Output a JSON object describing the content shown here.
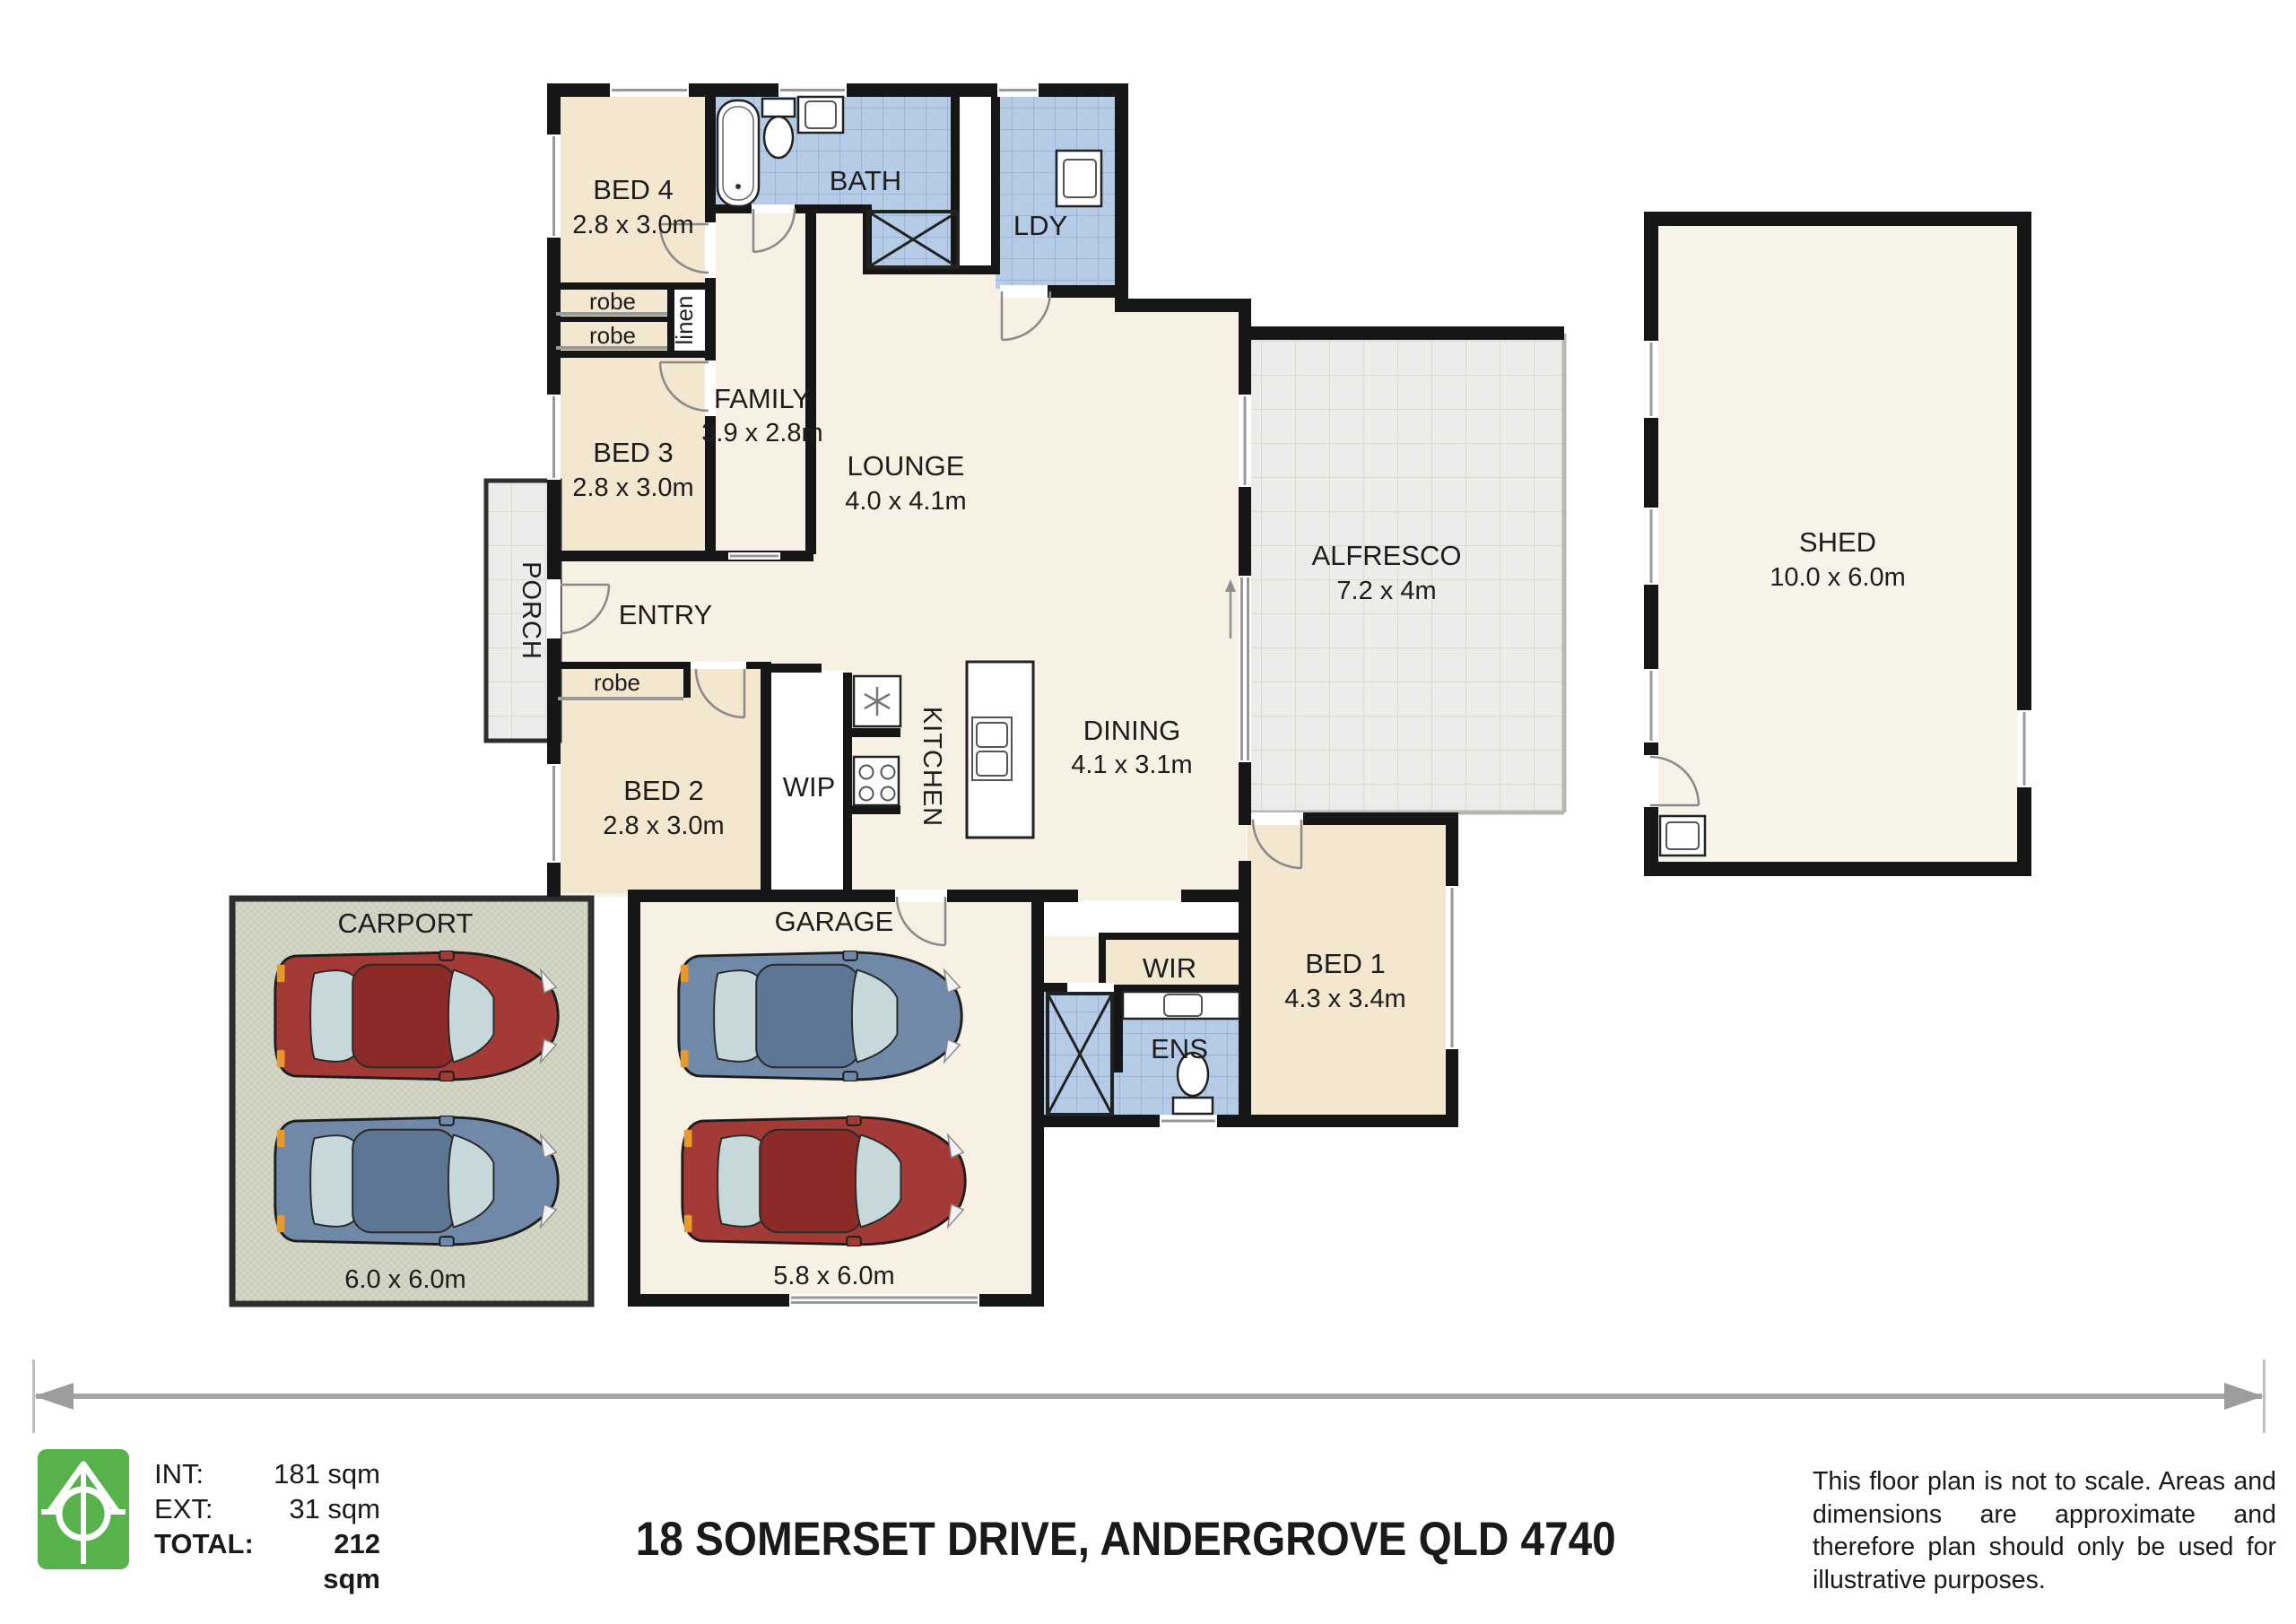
{
  "plan": {
    "rooms": {
      "bed4": {
        "name": "BED 4",
        "dims": "2.8 x 3.0m"
      },
      "bed3": {
        "name": "BED 3",
        "dims": "2.8 x 3.0m"
      },
      "bed2": {
        "name": "BED 2",
        "dims": "2.8 x 3.0m"
      },
      "bed1": {
        "name": "BED 1",
        "dims": "4.3 x 3.4m"
      },
      "bath": {
        "name": "BATH"
      },
      "ldy": {
        "name": "LDY"
      },
      "family": {
        "name": "FAMILY",
        "dims": "3.9 x 2.8m"
      },
      "lounge": {
        "name": "LOUNGE",
        "dims": "4.0 x 4.1m"
      },
      "dining": {
        "name": "DINING",
        "dims": "4.1 x 3.1m"
      },
      "kitchen": {
        "name": "KITCHEN"
      },
      "wip": {
        "name": "WIP"
      },
      "entry": {
        "name": "ENTRY"
      },
      "porch": {
        "name": "PORCH"
      },
      "alfresco": {
        "name": "ALFRESCO",
        "dims": "7.2 x 4m"
      },
      "wir": {
        "name": "WIR"
      },
      "ens": {
        "name": "ENS"
      },
      "garage": {
        "name": "GARAGE",
        "dims": "5.8 x 6.0m"
      },
      "carport": {
        "name": "CARPORT",
        "dims": "6.0 x 6.0m"
      },
      "shed": {
        "name": "SHED",
        "dims": "10.0 x 6.0m"
      },
      "robe_a": {
        "name": "robe"
      },
      "robe_b": {
        "name": "robe"
      },
      "robe_c": {
        "name": "robe"
      },
      "linen": {
        "name": "linen"
      }
    }
  },
  "footer": {
    "areas": [
      {
        "label": "INT:",
        "value": "181 sqm"
      },
      {
        "label": "EXT:",
        "value": "31 sqm"
      },
      {
        "label": "TOTAL:",
        "value": "212 sqm"
      }
    ],
    "address": "18 SOMERSET DRIVE, ANDERGROVE QLD 4740",
    "disclaimer": "This floor plan is not to scale. Areas and dimensions are approximate and therefore plan should only be used for illustrative purposes."
  },
  "colors": {
    "wall": "#161616",
    "floor_living": "#f7f1e3",
    "floor_bedroom": "#f4e7cf",
    "tile_wet": "#b5cbe6",
    "tile_outdoor": "#ececea",
    "carport_floor": "#d4d7c6",
    "logo_green": "#58b24b",
    "car_red": "#a43a36",
    "car_blue": "#7089a8"
  }
}
